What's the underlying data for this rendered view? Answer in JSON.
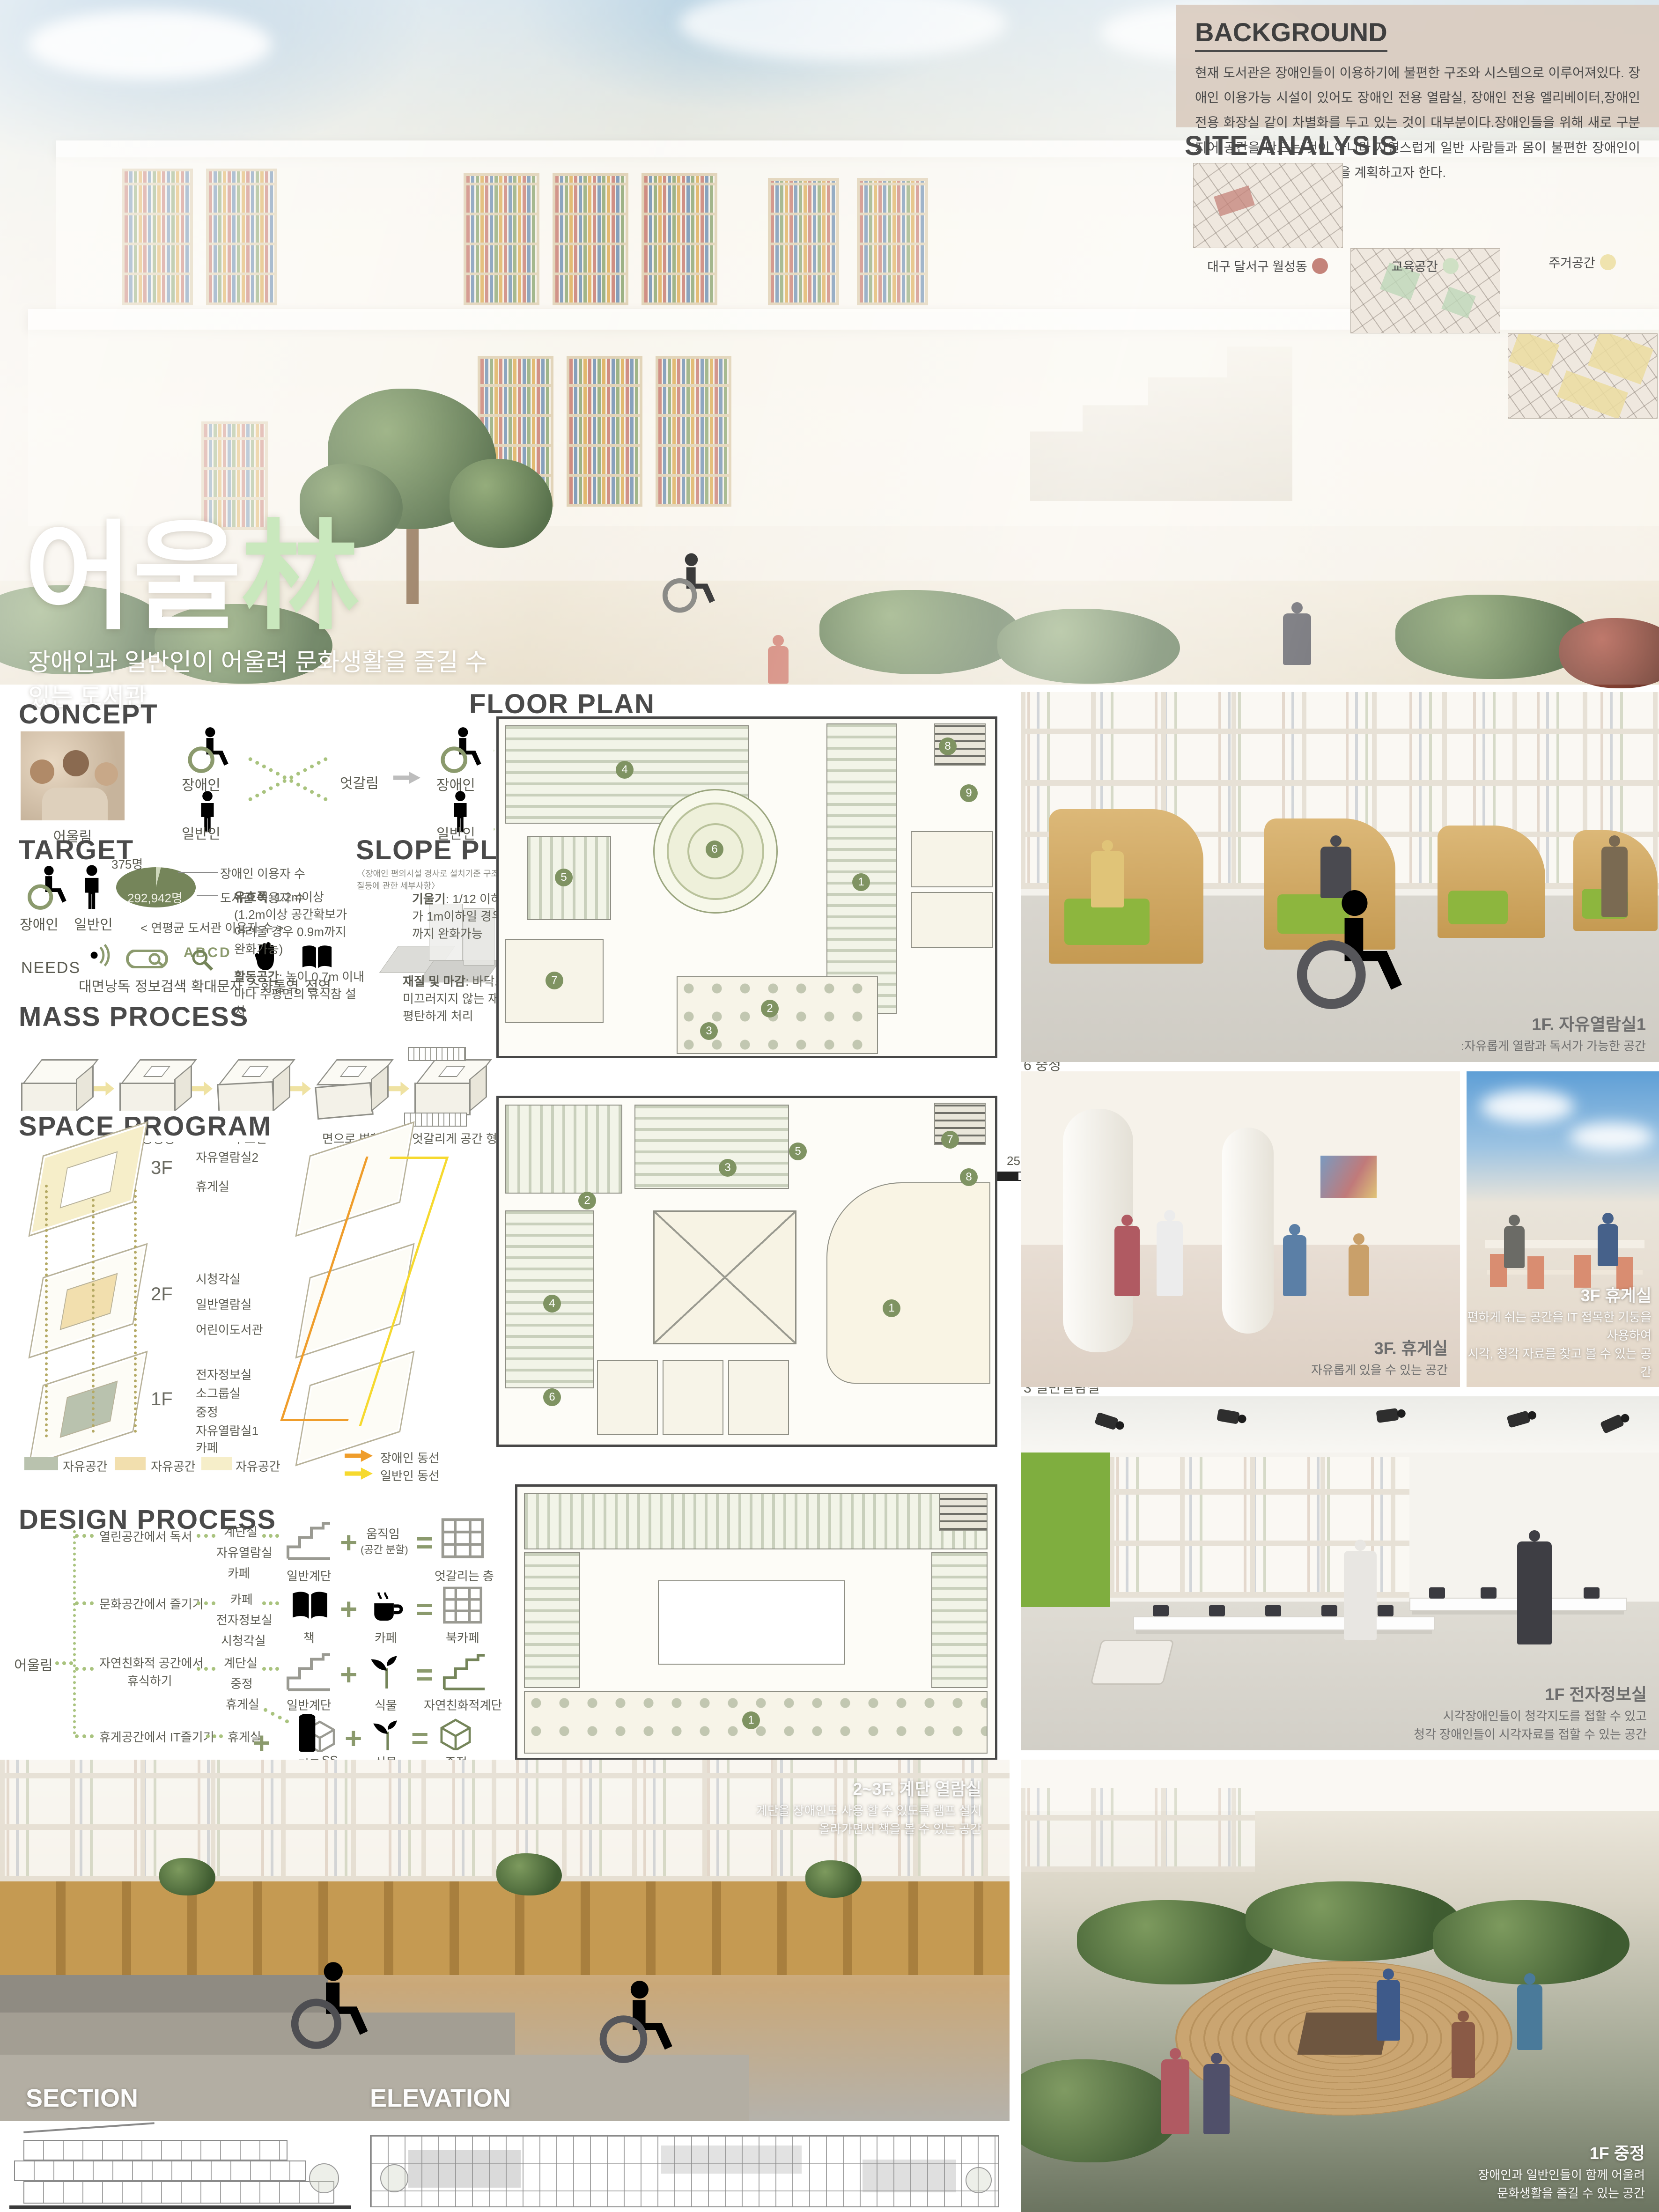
{
  "hero": {
    "title_ko": "어울",
    "title_hanja": "林",
    "subtitle": "장애인과 일반인이 어울려 문화생활을 즐길 수 있는 도서관"
  },
  "background_sec": {
    "title": "BACKGROUND",
    "body": "현재 도서관은 장애인들이 이용하기에 불편한 구조와 시스템으로 이루어져있다. 장애인 이용가능 시설이 있어도 장애인 전용 열람실, 장애인 전용 엘리베이터,장애인 전용 화장실 같이 차별화를 두고 있는 것이 대부분이다.장애인들을 위해 새로 구분 지어 공간을 만드는 것이 아니라 자연스럽게 일반 사람들과 몸이 불편한 장애인이 함께 이용이 편리한 도서관을 계획하고자 한다."
  },
  "site_analysis": {
    "title": "SITE ANALYSIS",
    "map1_label": "대구 달서구 월성동",
    "map2_label": "교육공간",
    "map3_label": "주거공간",
    "dot1": "#c4837a",
    "dot2": "#cfe0c4",
    "dot3": "#efe3ae"
  },
  "concept": {
    "title": "CONCEPT",
    "photo_caption": "어울림",
    "label_disabled": "장애인",
    "label_general": "일반인",
    "x_label": "엇갈림",
    "link_label": "연결",
    "pair_label": "장애인 일반인",
    "result_label": "어울림"
  },
  "target": {
    "title": "TARGET",
    "label_disabled": "장애인",
    "label_general": "일반인",
    "pie_small": "375명",
    "pie_big": "292,942명",
    "pie_label1": "장애인 이용자 수",
    "pie_label2": "도서관 이용자 수",
    "pie_caption": "< 연평균 도서관 이용자 수 >",
    "needs_title": "NEEDS",
    "need1": "대면낭독",
    "need2": "정보검색",
    "need3": "확대문자",
    "need4": "수화통역",
    "need5": "점역",
    "abcd": "ABCD"
  },
  "slope_plan": {
    "title": "SLOPE PLAN",
    "note": "〈장애인 편의시설 경사로 설치기준 구조 및 재질등에 관한 세부사항〉",
    "s1n": "유효폭",
    "s1d": ": 1.2m이상 (1.2m이상 공간확보가 어려울 경우 0.9m까지 완화가능)",
    "s2n": "기울기",
    "s2d": ": 1/12 이하 높이가 1m이하일 경우 8/1까지 완화가능",
    "s3n": "활동공간",
    "s3d": ": 높이 0.7m 이내마다 수평면의 휴식참 설치",
    "s4n": "재질 및 마감",
    "s4d": ": 바닥표면은 미끄러지지 않는 재질로 평탄하게 처리"
  },
  "mass_process": {
    "title": "MASS PROCESS",
    "step1": "MASS",
    "step2": "중정형성",
    "step3": "루프선",
    "step4": "면으로 변화",
    "step5": "엇갈리게 공간 형성"
  },
  "space_program": {
    "title": "SPACE PROGRAM",
    "f3": "3F",
    "f2": "2F",
    "f1": "1F",
    "r3a": "자유열람실2",
    "r3b": "휴게실",
    "r2a": "시청각실",
    "r2b": "일반열람실",
    "r2c": "어린이도서관",
    "r1a": "전자정보실",
    "r1b": "소그룹실",
    "r1c": "중정",
    "r1d": "자유열람실1",
    "r1e": "카페",
    "legend1": "자유공간",
    "legend2": "자유공간",
    "legend3": "자유공간",
    "circ1": "장애인 동선",
    "circ2": "일반인 동선"
  },
  "design_process": {
    "title": "DESIGN PROCESS",
    "root": "어울림",
    "plus": "+",
    "equals": "=",
    "r1": {
      "activity": "열린공간에서 독서",
      "s1": "계단실",
      "s2": "자유열람실",
      "s3": "카페",
      "a": "일반계단",
      "b": "움직임",
      "b2": "(공간 분할)",
      "res": "엇갈리는 층"
    },
    "r2": {
      "activity": "문화공간에서 즐기기",
      "s1": "카페",
      "s2": "전자정보실",
      "s3": "시청각실",
      "a": "책",
      "b": "카페",
      "res": "북카페"
    },
    "r3": {
      "activity": "자연친화적 공간에서",
      "activity2": "휴식하기",
      "s1": "계단실",
      "s2": "중정",
      "s3": "휴게실",
      "a": "일반계단",
      "b": "식물",
      "res": "자연친화적계단"
    },
    "sub": {
      "a": "MASS",
      "b": "식물",
      "res": "중정"
    },
    "r4": {
      "activity": "휴게공간에서 IT즐기기",
      "s1": "휴게실",
      "a": "기둥",
      "b": "컴퓨터",
      "res": "옥상휴게실"
    }
  },
  "floor_plan": {
    "title": "FLOOR PLAN",
    "f1": {
      "label": "1F",
      "scale": "25(m)",
      "i1": "1 자유열람실",
      "i2": "2 카페",
      "i3": "3 직원실",
      "i4": "4 소그룹실",
      "i5": "5 전자정보실",
      "i6": "6 중정",
      "i7": "7 계단실1",
      "i8": "8 계단실2",
      "i9": "9 화장실"
    },
    "f2": {
      "label": "2F",
      "i1": "1 어린이도서관",
      "i2": "2 자유열람실2",
      "i3": "3 일반열람실",
      "i4": "4 세미나실",
      "i5": "5 시청각실",
      "i6": "6 계단실1",
      "i7": "7 계단실2",
      "i8": "8 화장실"
    },
    "f3": {
      "label": "3F",
      "i1": "1 휴게실"
    },
    "badges": {
      "b1": "1",
      "b2": "2",
      "b3": "3",
      "b4": "4",
      "b5": "5",
      "b6": "6",
      "b7": "7",
      "b8": "8",
      "b9": "9"
    }
  },
  "renders": {
    "r1": {
      "title": "1F. 자유열람실1",
      "l1": ":자유롭게 열람과 독서가 가능한 공간"
    },
    "r2": {
      "title": "3F. 휴게실",
      "l1": "자유롭게 있을 수 있는 공간"
    },
    "r3": {
      "title": "3F 휴게실",
      "l1": "편하게 쉬는 공간을 IT 접목한 기둥을 사용하여",
      "l2": "시각, 청각 자료를 찾고 볼 수 있는 공간"
    },
    "r4": {
      "title": "1F 전자정보실",
      "l1": "시각장애인들이 청각지도를 접할 수 있고",
      "l2": "청각 장애인들이 시각자료를 접할 수 있는 공간"
    },
    "r5": {
      "title": "2~3F. 계단 열람실",
      "l1": "계단을 장애인도 사용 할 수 있도록 램프 설치",
      "l2": "올라가면서 책을 볼 수 있는 공간"
    },
    "r6": {
      "title": "1F 중정",
      "l1": "장애인과 일반인들이 함께 어울려",
      "l2": "문화생활을 즐길 수 있는 공간"
    }
  },
  "bottom": {
    "section_label": "SECTION",
    "elevation_label": "ELEVATION"
  }
}
